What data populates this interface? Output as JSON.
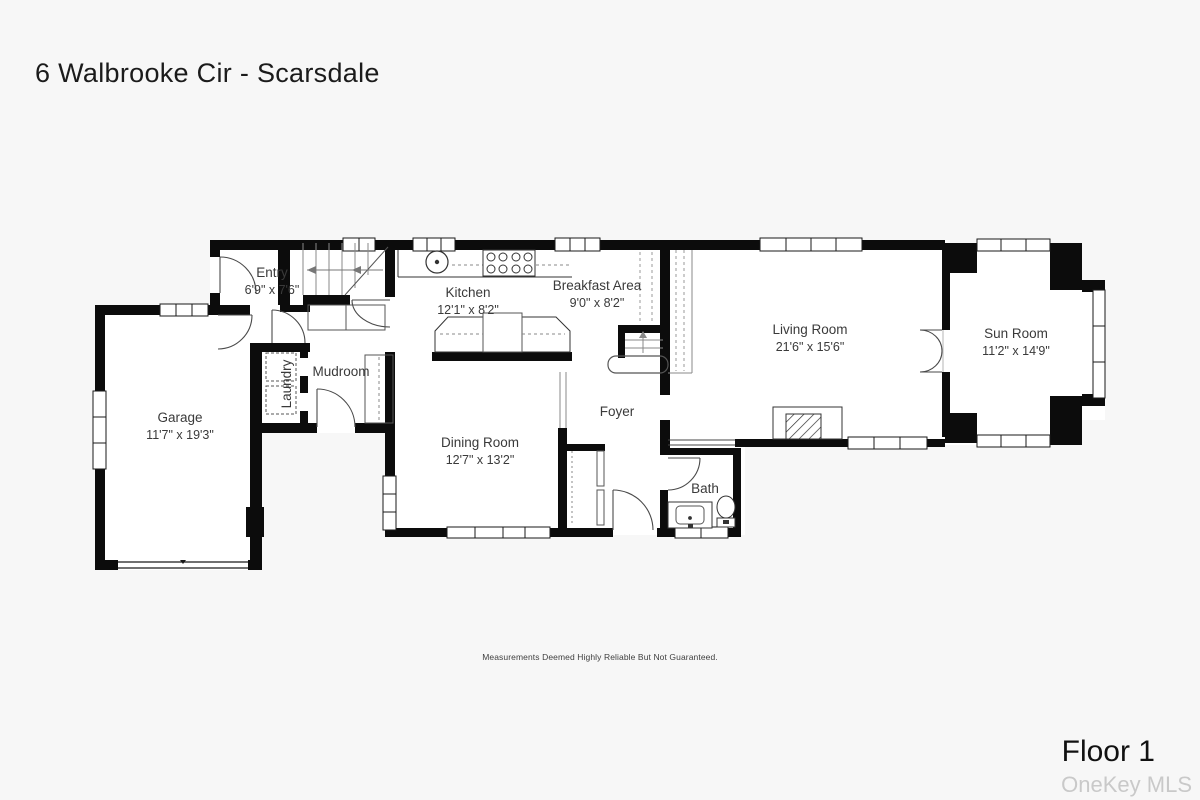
{
  "title": "6 Walbrooke Cir - Scarsdale",
  "floor_label": "Floor 1",
  "watermark": "OneKey MLS",
  "disclaimer": "Measurements Deemed Highly Reliable But Not Guaranteed.",
  "rooms": {
    "entry": {
      "name": "Entry",
      "dims": "6'9\" x 7'6\""
    },
    "kitchen": {
      "name": "Kitchen",
      "dims": "12'1\" x 8'2\""
    },
    "breakfast": {
      "name": "Breakfast Area",
      "dims": "9'0\" x 8'2\""
    },
    "living": {
      "name": "Living Room",
      "dims": "21'6\" x 15'6\""
    },
    "sunroom": {
      "name": "Sun Room",
      "dims": "11'2\" x 14'9\""
    },
    "garage": {
      "name": "Garage",
      "dims": "11'7\" x 19'3\""
    },
    "laundry": {
      "name": "Laundry",
      "dims": ""
    },
    "mudroom": {
      "name": "Mudroom",
      "dims": ""
    },
    "dining": {
      "name": "Dining Room",
      "dims": "12'7\" x 13'2\""
    },
    "foyer": {
      "name": "Foyer",
      "dims": ""
    },
    "bath": {
      "name": "Bath",
      "dims": ""
    }
  },
  "colors": {
    "background": "#f7f7f7",
    "wall": "#0c0c0c",
    "floor": "#ffffff",
    "watermark_gray": "#c9c9c9"
  }
}
